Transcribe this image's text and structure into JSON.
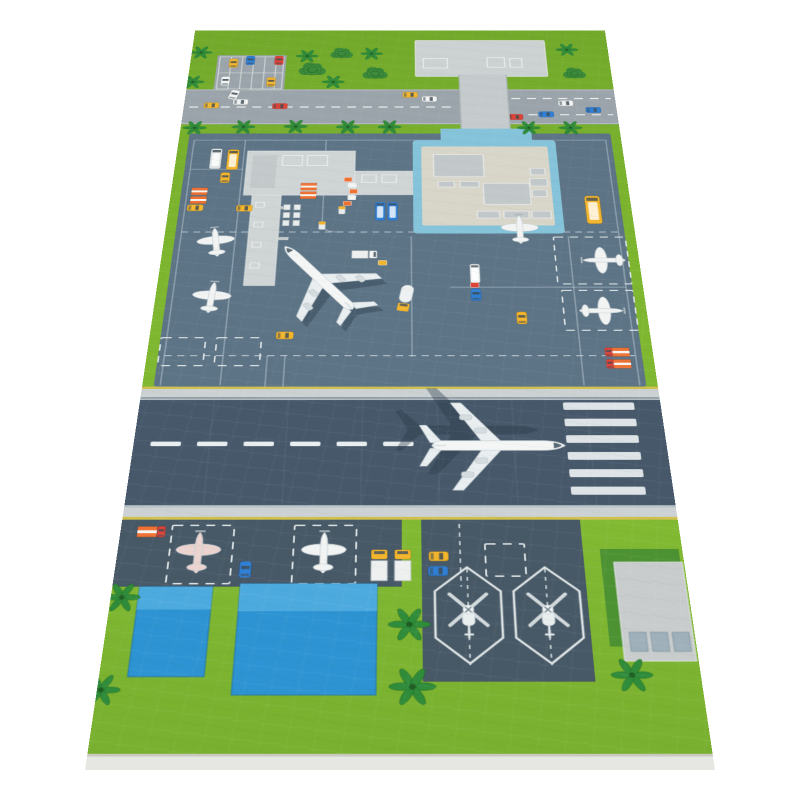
{
  "palette": {
    "grass": "#7cb42e",
    "grass_dark": "#72a92b",
    "grass_light": "#8cc23a",
    "road": "#9ba4ab",
    "road_line": "#edf0ee",
    "apron": "#5d7486",
    "runway": "#46586a",
    "darkzone": "#475866",
    "strip": "#ccd2d3",
    "yellow_line": "#cfc04f",
    "building_gray": "#ccd1d2",
    "walkway_gray": "#c5cbcd",
    "terminal_roof_blue": "#85c3da",
    "terminal_roof_beige": "#d8d5c9",
    "roof_detail": "#c2c8ca",
    "pier_gray": "#cfd4d5",
    "hangar_blue": "#2d93d2",
    "hangar_blue_light": "#54aee0",
    "pad_gray": "#c8cccc",
    "pad_green": "#4d9232",
    "pad_vent": "#9fb0ba",
    "fabric_edge": "#e6e7e2",
    "plane_white": "#f2f4f4",
    "shadow": "rgba(40,55,70,0.38)",
    "veh_yellow": "#f3b52c",
    "veh_red": "#df4337",
    "veh_blue": "#2f7fd6",
    "veh_white": "#f2f4f4",
    "veh_orange": "#ef7133",
    "tree_green": "#2f8c3a",
    "bush_green": "#3a8a3a",
    "marking_white": "#e9eef0"
  },
  "scene": {
    "layers": {
      "parking_cars": [
        {
          "sym": "car",
          "x": 65,
          "y": 84,
          "c": "veh_yellow"
        },
        {
          "sym": "car",
          "x": 90,
          "y": 77,
          "c": "veh_blue"
        },
        {
          "sym": "car",
          "x": 133,
          "y": 77,
          "c": "veh_red"
        },
        {
          "sym": "car",
          "x": 56,
          "y": 128,
          "c": "veh_white"
        },
        {
          "sym": "car",
          "x": 124,
          "y": 130,
          "c": "veh_yellow"
        }
      ],
      "road_cars": [
        {
          "sym": "car",
          "x": 40,
          "y": 186,
          "r": 90,
          "c": "veh_yellow"
        },
        {
          "sym": "car",
          "x": 82,
          "y": 178,
          "r": 90,
          "c": "veh_white"
        },
        {
          "sym": "car",
          "x": 140,
          "y": 188,
          "r": 90,
          "c": "veh_red"
        },
        {
          "sym": "car",
          "x": 330,
          "y": 161,
          "r": 90,
          "c": "veh_yellow"
        },
        {
          "sym": "car",
          "x": 358,
          "y": 171,
          "r": 90,
          "c": "veh_white"
        },
        {
          "sym": "car",
          "x": 482,
          "y": 213,
          "r": 90,
          "c": "veh_red"
        },
        {
          "sym": "car",
          "x": 527,
          "y": 207,
          "r": 90,
          "c": "veh_blue"
        },
        {
          "sym": "car",
          "x": 557,
          "y": 181,
          "r": 90,
          "c": "veh_white"
        },
        {
          "sym": "car",
          "x": 596,
          "y": 197,
          "r": 90,
          "c": "veh_blue"
        },
        {
          "sym": "car",
          "x": 71,
          "y": 161,
          "r": 15,
          "c": "veh_white"
        }
      ],
      "apron": [
        {
          "sym": "bus",
          "x": 56,
          "y": 307,
          "c": "#dfe3e4"
        },
        {
          "sym": "bus",
          "x": 80,
          "y": 309,
          "c": "veh_yellow"
        },
        {
          "sym": "car",
          "x": 72,
          "y": 348,
          "c": "veh_yellow"
        },
        {
          "sym": "container",
          "x": 39,
          "y": 377,
          "c": "veh_orange"
        },
        {
          "sym": "container",
          "x": 39,
          "y": 395,
          "c": "veh_orange"
        },
        {
          "sym": "car",
          "x": 36,
          "y": 411,
          "r": 90,
          "c": "veh_yellow"
        },
        {
          "sym": "car",
          "x": 103,
          "y": 412,
          "r": 90,
          "c": "veh_yellow"
        },
        {
          "sym": "container",
          "x": 189,
          "y": 367,
          "c": "veh_orange"
        },
        {
          "sym": "container",
          "x": 189,
          "y": 385,
          "c": "veh_orange"
        },
        {
          "sym": "dolly",
          "x": 161,
          "y": 410
        },
        {
          "sym": "dolly",
          "x": 175,
          "y": 410
        },
        {
          "sym": "dolly",
          "x": 161,
          "y": 426
        },
        {
          "sym": "dolly",
          "x": 175,
          "y": 426
        },
        {
          "sym": "dolly",
          "x": 161,
          "y": 442
        },
        {
          "sym": "dolly",
          "x": 175,
          "y": 442
        },
        {
          "sym": "cart",
          "x": 243,
          "y": 352,
          "c": "veh_orange"
        },
        {
          "sym": "cart",
          "x": 249,
          "y": 364,
          "c": "veh_white"
        },
        {
          "sym": "cart",
          "x": 251,
          "y": 377,
          "c": "veh_orange"
        },
        {
          "sym": "cart",
          "x": 249,
          "y": 390,
          "c": "veh_white"
        },
        {
          "sym": "cart",
          "x": 243,
          "y": 402,
          "c": "veh_orange"
        },
        {
          "sym": "tug",
          "x": 236,
          "y": 416
        },
        {
          "sym": "bus",
          "x": 288,
          "y": 418,
          "s": 0.85,
          "c": "veh_blue"
        },
        {
          "sym": "bus",
          "x": 305,
          "y": 418,
          "s": 0.85,
          "c": "veh_blue"
        },
        {
          "sym": "tug",
          "x": 210,
          "y": 447
        },
        {
          "sym": "truck",
          "x": 268,
          "y": 504,
          "r": 90,
          "s": 0.8,
          "c": "veh_white"
        },
        {
          "sym": "cart",
          "x": 292,
          "y": 520,
          "c": "veh_yellow"
        },
        {
          "sym": "fueltruck",
          "x": 322,
          "y": 586,
          "r": 10,
          "c": "veh_yellow"
        },
        {
          "sym": "car",
          "x": 170,
          "y": 653,
          "r": 90,
          "c": "veh_yellow"
        },
        {
          "sym": "bus",
          "x": 578,
          "y": 415,
          "s": 1.3,
          "c": "veh_yellow"
        },
        {
          "sym": "bus",
          "x": 413,
          "y": 540,
          "s": 0.8,
          "c": "veh_white"
        },
        {
          "sym": "cart",
          "x": 412,
          "y": 562,
          "c": "veh_red"
        },
        {
          "sym": "car",
          "x": 413,
          "y": 580,
          "c": "veh_blue"
        },
        {
          "sym": "car",
          "x": 470,
          "y": 622,
          "c": "veh_yellow"
        },
        {
          "sym": "container",
          "x": 590,
          "y": 682,
          "c": "veh_orange"
        },
        {
          "sym": "container",
          "x": 590,
          "y": 702,
          "c": "veh_orange"
        },
        {
          "sym": "car",
          "x": 575,
          "y": 682,
          "s": 0.7,
          "c": "veh_red"
        },
        {
          "sym": "car",
          "x": 575,
          "y": 702,
          "s": 0.7,
          "c": "veh_red"
        },
        {
          "sym": "smallplane",
          "x": 70,
          "y": 482,
          "r": -8,
          "n": "small-plane"
        },
        {
          "sym": "smallplane",
          "x": 72,
          "y": 587,
          "r": 4,
          "n": "small-plane"
        },
        {
          "sym": "smallplane",
          "x": 476,
          "y": 457,
          "n": "small-plane"
        },
        {
          "sym": "smallplane",
          "x": 586,
          "y": 515,
          "r": -90,
          "n": "small-plane"
        },
        {
          "sym": "smallplane",
          "x": 570,
          "y": 609,
          "r": 90,
          "n": "small-plane"
        },
        {
          "sym": "airliner-sil",
          "x": 222,
          "y": 566,
          "r": -38,
          "c": "shadow",
          "n": "apron-airliner-shadow"
        },
        {
          "sym": "airliner",
          "x": 215,
          "y": 556,
          "r": -38,
          "n": "apron-airliner"
        }
      ],
      "runway": [
        {
          "sym": "airliner-sil",
          "x": 391,
          "y": 810,
          "r": 90,
          "s": 1.05,
          "c": "shadow",
          "n": "runway-airliner-shadow"
        },
        {
          "sym": "airliner",
          "x": 420,
          "y": 834,
          "r": 90,
          "s": 1.05,
          "n": "runway-airliner"
        }
      ],
      "bottom": [
        {
          "sym": "container",
          "x": 30,
          "y": 961,
          "c": "veh_orange"
        },
        {
          "sym": "car",
          "x": 46,
          "y": 961,
          "s": 0.7,
          "c": "veh_red"
        },
        {
          "sym": "smallplane",
          "x": 90,
          "y": 992,
          "c": "#ecd3cf",
          "n": "small-plane-red"
        },
        {
          "sym": "smallplane",
          "x": 230,
          "y": 992,
          "n": "small-plane"
        },
        {
          "sym": "car",
          "x": 144,
          "y": 1013,
          "c": "veh_blue"
        },
        {
          "sym": "truck",
          "x": 292,
          "y": 1007,
          "c": "veh_yellow"
        },
        {
          "sym": "truck",
          "x": 318,
          "y": 1007,
          "c": "veh_yellow"
        },
        {
          "sym": "car",
          "x": 358,
          "y": 995,
          "r": 90,
          "c": "veh_yellow"
        },
        {
          "sym": "car",
          "x": 357,
          "y": 1015,
          "r": 90,
          "c": "veh_blue"
        },
        {
          "sym": "heli",
          "x": 389,
          "y": 1066,
          "s": 0.85,
          "n": "helicopter-1"
        },
        {
          "sym": "heli",
          "x": 475,
          "y": 1066,
          "s": 0.85,
          "n": "helicopter-2"
        }
      ],
      "trees": [
        {
          "sym": "palm",
          "x": 14,
          "y": 57
        },
        {
          "sym": "palm",
          "x": 8,
          "y": 130
        },
        {
          "sym": "palm",
          "x": 175,
          "y": 66
        },
        {
          "sym": "palm",
          "x": 272,
          "y": 60
        },
        {
          "sym": "palm",
          "x": 216,
          "y": 130
        },
        {
          "sym": "palm",
          "x": 568,
          "y": 50
        },
        {
          "sym": "bush",
          "x": 227,
          "y": 60
        },
        {
          "sym": "bush",
          "x": 184,
          "y": 100,
          "s": 1.2
        },
        {
          "sym": "bush",
          "x": 278,
          "y": 110,
          "s": 1.1
        },
        {
          "sym": "bush",
          "x": 575,
          "y": 110
        },
        {
          "sym": "palm",
          "x": 20,
          "y": 238
        },
        {
          "sym": "palm",
          "x": 90,
          "y": 236
        },
        {
          "sym": "palm",
          "x": 165,
          "y": 235
        },
        {
          "sym": "palm",
          "x": 240,
          "y": 236
        },
        {
          "sym": "palm",
          "x": 300,
          "y": 236
        },
        {
          "sym": "palm",
          "x": 500,
          "y": 238
        },
        {
          "sym": "palm",
          "x": 560,
          "y": 238
        },
        {
          "sym": "palm",
          "x": 12,
          "y": 1050,
          "s": 1.2
        },
        {
          "sym": "palm",
          "x": 325,
          "y": 1085,
          "s": 1.35
        },
        {
          "sym": "palm",
          "x": 328,
          "y": 1162,
          "s": 1.45
        },
        {
          "sym": "palm",
          "x": 558,
          "y": 1148,
          "s": 1.3
        },
        {
          "sym": "palm",
          "x": 4,
          "y": 1166,
          "s": 1.2
        }
      ]
    }
  }
}
